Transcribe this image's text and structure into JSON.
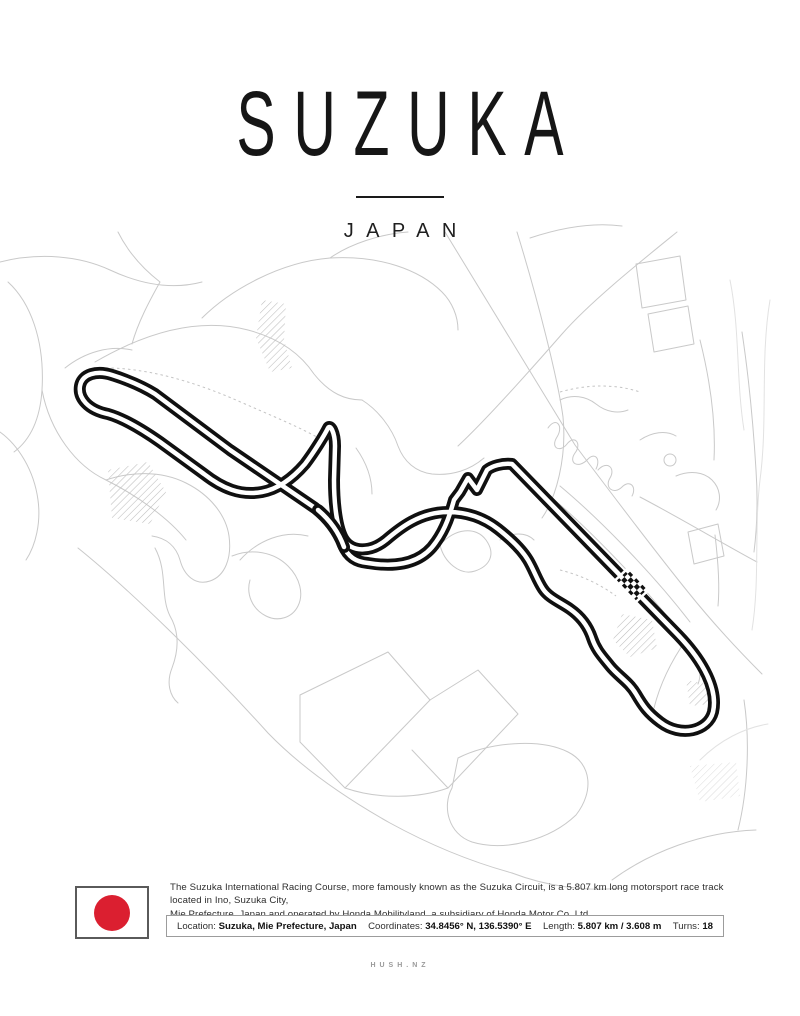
{
  "poster": {
    "title": "SUZUKA",
    "subtitle": "JAPAN",
    "description_line1": "The Suzuka International Racing Course, more famously known as the Suzuka Circuit, is a 5.807 km long motorsport race track located in Ino, Suzuka City,",
    "description_line2": "Mie Prefecture, Japan and operated by Honda Mobilityland, a subsidiary of Honda Motor Co, Ltd.",
    "brand": "HUSH.NZ"
  },
  "info": {
    "location_label": "Location:",
    "location_value": "Suzuka, Mie Prefecture, Japan",
    "coordinates_label": "Coordinates:",
    "coordinates_value": "34.8456° N, 136.5390° E",
    "length_label": "Length:",
    "length_value": "5.807 km / 3.608 m",
    "turns_label": "Turns:",
    "turns_value": "18"
  },
  "flag": {
    "name": "japan-flag",
    "circle_color": "#DB1F30",
    "border_color": "#5A5A5A"
  },
  "map": {
    "track_name": "Suzuka International Racing Course",
    "track_color": "#101010",
    "track_core_color": "#FFFFFF",
    "road_color": "#C9C9C9",
    "faint_road_color": "#E2E2E2",
    "hatch_color": "#BDBDBD",
    "start_finish_marker": "checkered-flag"
  }
}
